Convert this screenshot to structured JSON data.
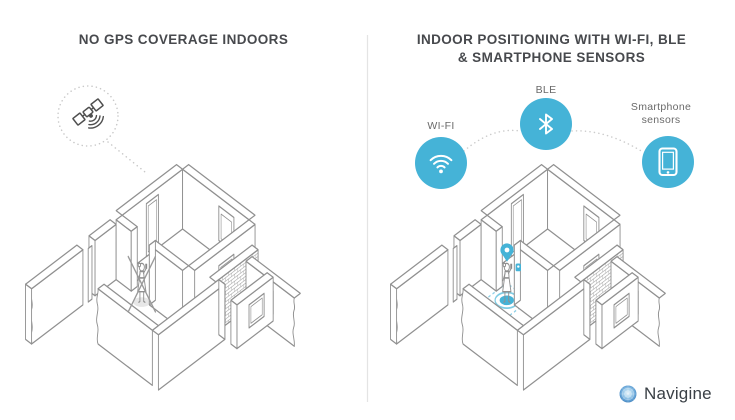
{
  "panels": {
    "left": {
      "title": "NO GPS COVERAGE INDOORS"
    },
    "right": {
      "title_line1": "INDOOR POSITIONING WITH WI-FI, BLE",
      "title_line2": "& SMARTPHONE SENSORS",
      "beacon_labels": {
        "wifi": "WI-FI",
        "ble": "BLE",
        "smartphone_line1": "Smartphone",
        "smartphone_line2": "sensors"
      }
    }
  },
  "branding": {
    "company": "Navigine"
  },
  "colors": {
    "accent_blue": "#45b3d7",
    "accent_blue_light": "#8fd0e6",
    "sketch_line": "#909090",
    "satellite_line": "#4f4f4f",
    "title_text": "#47494d",
    "label_text": "#6a6a6a",
    "divider": "#e4e4e4"
  }
}
